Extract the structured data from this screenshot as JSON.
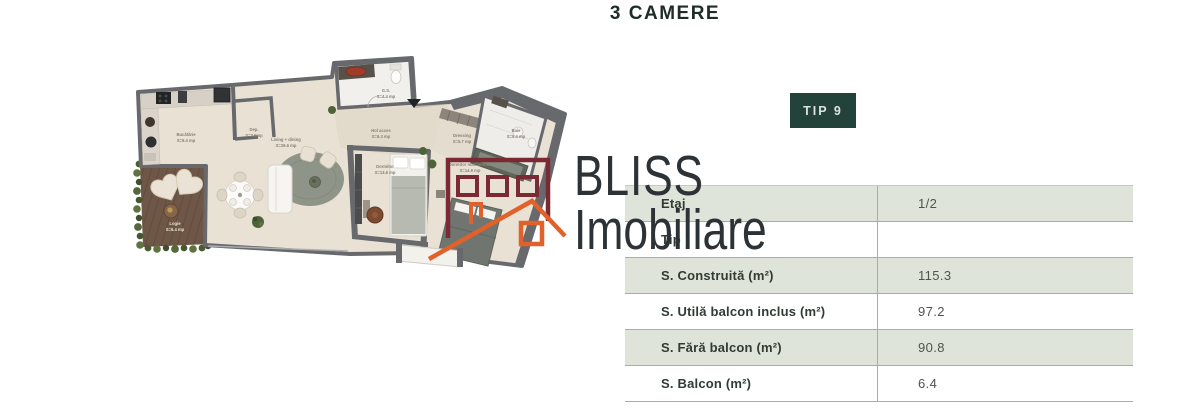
{
  "page": {
    "title": "3 CAMERE"
  },
  "badge": {
    "label": "TIP 9",
    "bg": "#22423a",
    "fg": "#dce3de"
  },
  "watermark": {
    "line1": "BLISS",
    "line2": "Imobiliare",
    "color": "#2d3236"
  },
  "logo": {
    "maroon": "#7b2a33",
    "orange": "#e2602a"
  },
  "spec_table": {
    "row_green_color": "#dee4da",
    "rows": [
      {
        "label": "Etaj",
        "value": "1/2"
      },
      {
        "label": "Tip",
        "value": ""
      },
      {
        "label": "S. Construită (m²)",
        "value": "115.3"
      },
      {
        "label": "S. Utilă balcon inclus (m²)",
        "value": "97.2"
      },
      {
        "label": "S. Fără balcon (m²)",
        "value": "90.8"
      },
      {
        "label": "S. Balcon (m²)",
        "value": "6.4"
      }
    ]
  },
  "floorplan": {
    "rooms": [
      {
        "name": "Bucătărie",
        "area": "S=9.4 mp"
      },
      {
        "name": "Dep.",
        "area": "S=2.5mp"
      },
      {
        "name": "Living + dining",
        "area": "S=26.6 mp"
      },
      {
        "name": "G.S.",
        "area": "S=4.4 mp"
      },
      {
        "name": "Hol acces",
        "area": "S=6.3 mp"
      },
      {
        "name": "Dormitor",
        "area": "S=13.6 mp"
      },
      {
        "name": "Dressing",
        "area": "S=5.7 mp"
      },
      {
        "name": "Baie",
        "area": "S=5.4 mp"
      },
      {
        "name": "Dormitor matrimonial",
        "area": "S=14.9 mp"
      },
      {
        "name": "Logie",
        "area": "S=6.4 mp"
      }
    ]
  }
}
